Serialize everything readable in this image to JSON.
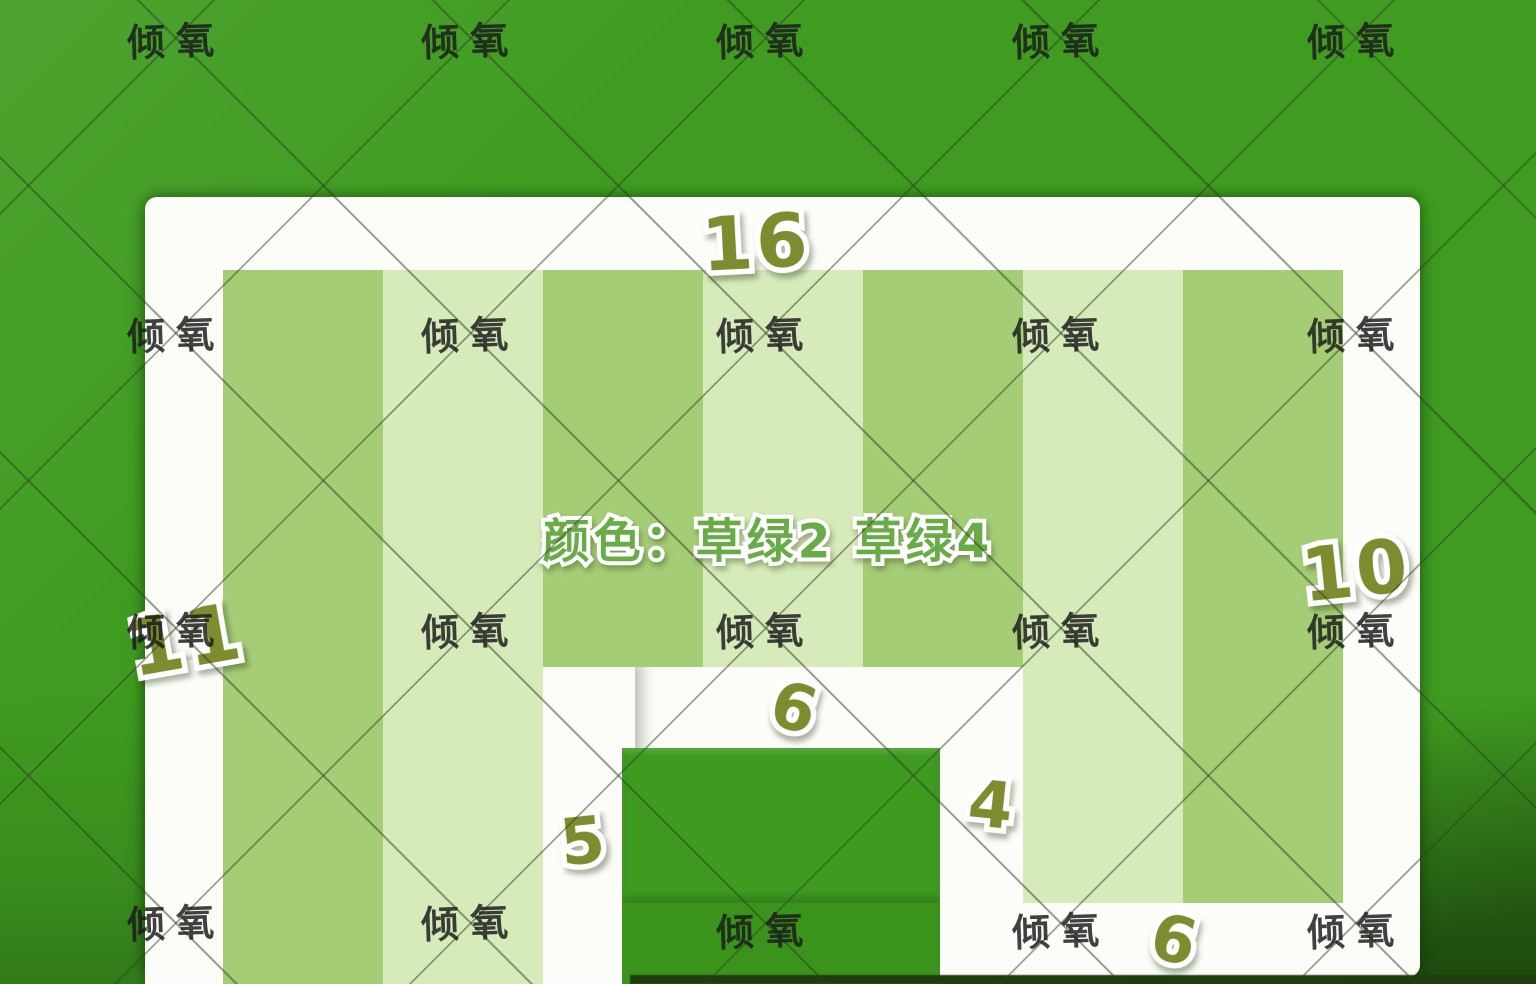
{
  "watermark": {
    "text": "倾氧"
  },
  "color_note": {
    "text": "颜色：草绿2 草绿4"
  },
  "measurements": {
    "top_width": "16",
    "left_height": "11",
    "right_height": "10",
    "gap_top_width": "6",
    "gap_left_height": "5",
    "gap_right_height": "4",
    "bottom_right_width": "6"
  },
  "palette": {
    "background_green": "#3f9c20",
    "stripe_medium_green": "#a5cd76",
    "stripe_light_green": "#d6eaba",
    "platform_white": "#fcfdf9",
    "number_olive": "#7e8c2f",
    "note_green": "#69ac47",
    "watermark_gray": "#1c1c1c"
  }
}
